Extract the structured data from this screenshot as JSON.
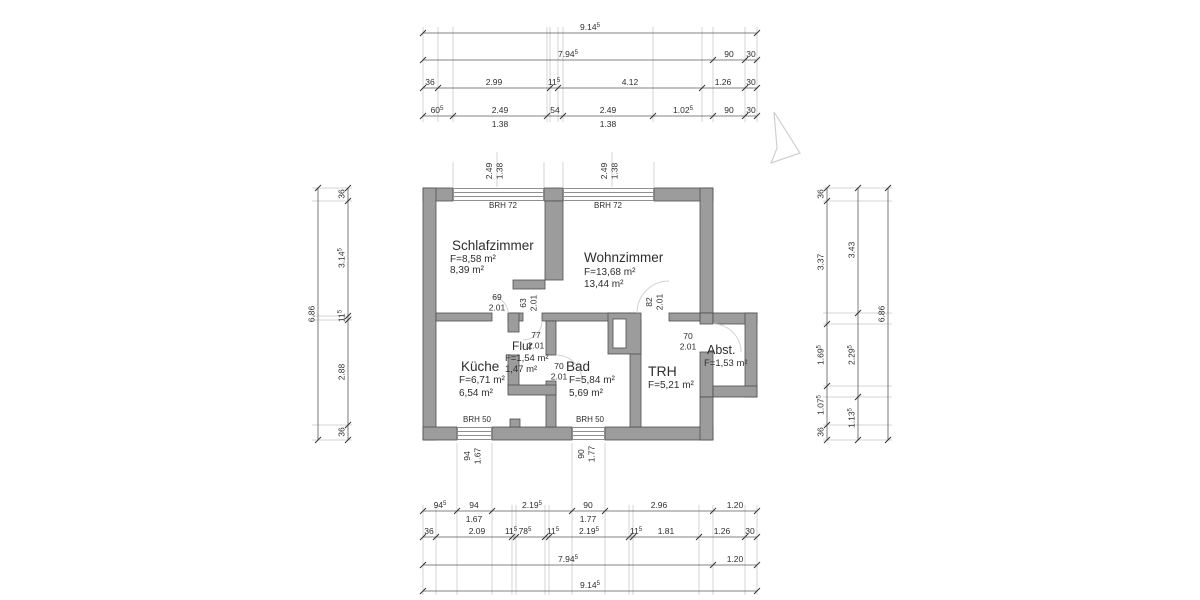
{
  "drawing_title": "floor-plan",
  "colors": {
    "wall_fill": "#9c9c9c",
    "wall_stroke": "#4f4f4f",
    "dim_line": "#5a5a5a",
    "dim_text": "#2e2e2e",
    "witness": "#c9c9c9",
    "window_line": "#8f8f8f",
    "door_arc": "#d2d2d2",
    "north_arrow": "#d0d0d0",
    "room_text": "#1f1f1f"
  },
  "rooms": [
    {
      "id": "schlafzimmer",
      "name": "Schlafzimmer",
      "line1": "F=8,58 m²",
      "line2": "8,39 m²",
      "nx": 452,
      "ny": 250,
      "lx": 450,
      "l1y": 262,
      "l2y": 273,
      "nsize": 13.5,
      "lsize": 10
    },
    {
      "id": "wohnzimmer",
      "name": "Wohnzimmer",
      "line1": "F=13,68 m²",
      "line2": "13,44 m²",
      "nx": 584,
      "ny": 262,
      "lx": 584,
      "l1y": 275,
      "l2y": 287,
      "nsize": 13.5,
      "lsize": 10
    },
    {
      "id": "kueche",
      "name": "Küche",
      "line1": "F=6,71 m²",
      "line2": "6,54 m²",
      "nx": 461,
      "ny": 371,
      "lx": 459,
      "l1y": 383,
      "l2y": 396,
      "nsize": 13.5,
      "lsize": 10
    },
    {
      "id": "flur",
      "name": "Flur",
      "line1": "F=1,54 m²",
      "line2": "1,47 m²",
      "nx": 512,
      "ny": 350,
      "lx": 505,
      "l1y": 361,
      "l2y": 372,
      "nsize": 12,
      "lsize": 9.5
    },
    {
      "id": "bad",
      "name": "Bad",
      "line1": "F=5,84 m²",
      "line2": "5,69 m²",
      "nx": 566,
      "ny": 371,
      "lx": 569,
      "l1y": 383,
      "l2y": 396,
      "nsize": 13.5,
      "lsize": 10
    },
    {
      "id": "trh",
      "name": "TRH",
      "line1": "F=5,21 m²",
      "line2": "",
      "nx": 648,
      "ny": 376,
      "lx": 648,
      "l1y": 388,
      "nsize": 14,
      "lsize": 10
    },
    {
      "id": "abst",
      "name": "Abst.",
      "line1": "F=1,53 m²",
      "line2": "",
      "nx": 707,
      "ny": 354,
      "lx": 704,
      "l1y": 366,
      "nsize": 12.5,
      "lsize": 9.5
    }
  ],
  "dim_chains": {
    "top": [
      {
        "id": "top-overall",
        "pos": 33,
        "ticks": [
          423,
          757
        ],
        "labels": [
          {
            "at": 590,
            "text": "9.14",
            "sup": "5"
          }
        ]
      },
      {
        "id": "top-main",
        "pos": 60,
        "ticks": [
          423,
          713,
          745,
          757
        ],
        "labels": [
          {
            "at": 568,
            "text": "7.94",
            "sup": "5"
          },
          {
            "at": 729,
            "text": "90"
          },
          {
            "at": 751,
            "text": "30"
          }
        ]
      },
      {
        "id": "top-rooms",
        "pos": 88,
        "ticks": [
          423,
          438,
          550,
          558,
          702,
          745,
          757
        ],
        "labels": [
          {
            "at": 430,
            "text": "36"
          },
          {
            "at": 494,
            "text": "2.99"
          },
          {
            "at": 554,
            "text": "11",
            "sup": "5"
          },
          {
            "at": 630,
            "text": "4.12"
          },
          {
            "at": 723,
            "text": "1.26"
          },
          {
            "at": 751,
            "text": "30"
          }
        ]
      },
      {
        "id": "top-openings",
        "pos": 116,
        "ticks": [
          423,
          453,
          547,
          563,
          653,
          713,
          745,
          757
        ],
        "labels": [
          {
            "at": 437,
            "text": "60",
            "sup": "5"
          },
          {
            "at": 500,
            "text": "2.49",
            "below": "1.38"
          },
          {
            "at": 555,
            "text": "54"
          },
          {
            "at": 608,
            "text": "2.49",
            "below": "1.38"
          },
          {
            "at": 683,
            "text": "1.02",
            "sup": "5"
          },
          {
            "at": 729,
            "text": "90"
          },
          {
            "at": 751,
            "text": "30"
          }
        ]
      }
    ],
    "bottom": [
      {
        "id": "bottom-openings",
        "pos": 511,
        "ticks": [
          423,
          457,
          492,
          572,
          605,
          713,
          757
        ],
        "labels": [
          {
            "at": 440,
            "text": "94",
            "sup": "5"
          },
          {
            "at": 474,
            "text": "94",
            "below": "1.67"
          },
          {
            "at": 532,
            "text": "2.19",
            "sup": "5"
          },
          {
            "at": 588,
            "text": "90",
            "below": "1.77"
          },
          {
            "at": 659,
            "text": "2.96"
          },
          {
            "at": 735,
            "text": "1.20"
          }
        ]
      },
      {
        "id": "bottom-rooms",
        "pos": 537,
        "ticks": [
          423,
          436,
          512,
          516,
          545,
          549,
          629,
          633,
          699,
          745,
          757
        ],
        "labels": [
          {
            "at": 429,
            "text": "36"
          },
          {
            "at": 477,
            "text": "2.09"
          },
          {
            "at": 511,
            "text": "11",
            "sup": "5"
          },
          {
            "at": 525,
            "text": "78",
            "sup": "5"
          },
          {
            "at": 553,
            "text": "11",
            "sup": "5"
          },
          {
            "at": 589,
            "text": "2.19",
            "sup": "5"
          },
          {
            "at": 636,
            "text": "11",
            "sup": "5"
          },
          {
            "at": 666,
            "text": "1.81"
          },
          {
            "at": 722,
            "text": "1.26"
          },
          {
            "at": 750,
            "text": "30"
          }
        ]
      },
      {
        "id": "bottom-main",
        "pos": 565,
        "ticks": [
          423,
          713,
          757
        ],
        "labels": [
          {
            "at": 568,
            "text": "7.94",
            "sup": "5"
          },
          {
            "at": 735,
            "text": "1.20"
          }
        ]
      },
      {
        "id": "bottom-overall",
        "pos": 591,
        "ticks": [
          423,
          757
        ],
        "labels": [
          {
            "at": 590,
            "text": "9.14",
            "sup": "5"
          }
        ]
      }
    ],
    "left": [
      {
        "id": "left-overall",
        "pos": 318,
        "ticks": [
          188,
          440
        ],
        "labels": [
          {
            "at": 314,
            "text": "6.86"
          }
        ]
      },
      {
        "id": "left-rooms",
        "pos": 348,
        "ticks": [
          188,
          201,
          316,
          320,
          425,
          440
        ],
        "labels": [
          {
            "at": 194,
            "text": "36"
          },
          {
            "at": 258,
            "text": "3.14",
            "sup": "5"
          },
          {
            "at": 316,
            "text": "11",
            "sup": "5"
          },
          {
            "at": 372,
            "text": "2.88"
          },
          {
            "at": 432,
            "text": "36"
          }
        ]
      }
    ],
    "right": [
      {
        "id": "right-rooms",
        "pos": 827,
        "ticks": [
          188,
          201,
          324,
          386,
          425,
          440
        ],
        "labels": [
          {
            "at": 194,
            "text": "36"
          },
          {
            "at": 262,
            "text": "3.37"
          },
          {
            "at": 355,
            "text": "1.69",
            "sup": "5"
          },
          {
            "at": 405,
            "text": "1.07",
            "sup": "5"
          },
          {
            "at": 432,
            "text": "36"
          }
        ]
      },
      {
        "id": "right-ext",
        "pos": 858,
        "ticks": [
          188,
          313,
          397,
          440
        ],
        "labels": [
          {
            "at": 250,
            "text": "3.43"
          },
          {
            "at": 355,
            "text": "2.29",
            "sup": "5"
          },
          {
            "at": 418,
            "text": "1.13",
            "sup": "5"
          }
        ]
      },
      {
        "id": "right-overall",
        "pos": 888,
        "ticks": [
          188,
          440
        ],
        "labels": [
          {
            "at": 314,
            "text": "6.86"
          }
        ]
      }
    ]
  },
  "witness_lines": {
    "top": {
      "ticks": [
        423,
        438,
        453,
        547,
        550,
        558,
        563,
        653,
        702,
        713,
        745,
        757
      ],
      "from": 27,
      "to": 122
    },
    "top_window_edges": {
      "ticks": [
        453,
        544,
        563,
        654
      ],
      "from": 162,
      "to": 187
    },
    "top_window_centers": {
      "ticks": [
        497,
        612
      ],
      "from": 152,
      "to": 187
    },
    "bottom": {
      "ticks": [
        423,
        436,
        512,
        516,
        545,
        549,
        629,
        633,
        699,
        713,
        745,
        757
      ],
      "from": 505,
      "to": 595
    },
    "bottom_window_edges": {
      "ticks": [
        457,
        492,
        572,
        605
      ],
      "from": 443,
      "to": 595
    },
    "left": {
      "ticks": [
        188,
        201,
        316,
        320,
        425,
        440
      ],
      "from": 312,
      "to": 352
    },
    "right": {
      "ticks": [
        188,
        201,
        313,
        324,
        386,
        397,
        425,
        440
      ],
      "from": 823,
      "to": 892
    }
  },
  "annotations": [
    {
      "id": "brh-72-left",
      "lines": [
        "BRH 72"
      ],
      "x": 503,
      "y": 208,
      "size": 8
    },
    {
      "id": "brh-72-right",
      "lines": [
        "BRH 72"
      ],
      "x": 608,
      "y": 208,
      "size": 8
    },
    {
      "id": "brh-50-left",
      "lines": [
        "BRH 50"
      ],
      "x": 477,
      "y": 422,
      "size": 8
    },
    {
      "id": "brh-50-right",
      "lines": [
        "BRH 50"
      ],
      "x": 590,
      "y": 422,
      "size": 8
    },
    {
      "id": "window-top-left-dim",
      "lines": [
        "2.49",
        "1.38"
      ],
      "x": 492,
      "y": 171,
      "size": 8.5,
      "rot": -90
    },
    {
      "id": "window-top-right-dim",
      "lines": [
        "2.49",
        "1.38"
      ],
      "x": 607,
      "y": 171,
      "size": 8.5,
      "rot": -90
    },
    {
      "id": "window-bottom-left-dim",
      "lines": [
        "94",
        "1.67"
      ],
      "x": 470,
      "y": 456,
      "size": 8.5,
      "rot": -90
    },
    {
      "id": "window-bottom-right-dim",
      "lines": [
        "90",
        "1.77"
      ],
      "x": 584,
      "y": 454,
      "size": 8.5,
      "rot": -90
    },
    {
      "id": "door-69-dim",
      "lines": [
        "69",
        "2.01"
      ],
      "x": 497,
      "y": 300,
      "size": 8.5
    },
    {
      "id": "door-63-dim",
      "lines": [
        "63",
        "2.01"
      ],
      "x": 526,
      "y": 303,
      "size": 8.5,
      "rot": -90
    },
    {
      "id": "door-82-dim",
      "lines": [
        "82",
        "2.01"
      ],
      "x": 652,
      "y": 302,
      "size": 8.5,
      "rot": -90
    },
    {
      "id": "door-77-dim",
      "lines": [
        "77",
        "2.01"
      ],
      "x": 536,
      "y": 338,
      "size": 8.5
    },
    {
      "id": "door-70-bad-dim",
      "lines": [
        "70",
        "2.01"
      ],
      "x": 559,
      "y": 369,
      "size": 8.5
    },
    {
      "id": "door-70-abst-dim",
      "lines": [
        "70",
        "2.01"
      ],
      "x": 688,
      "y": 339,
      "size": 8.5
    }
  ]
}
